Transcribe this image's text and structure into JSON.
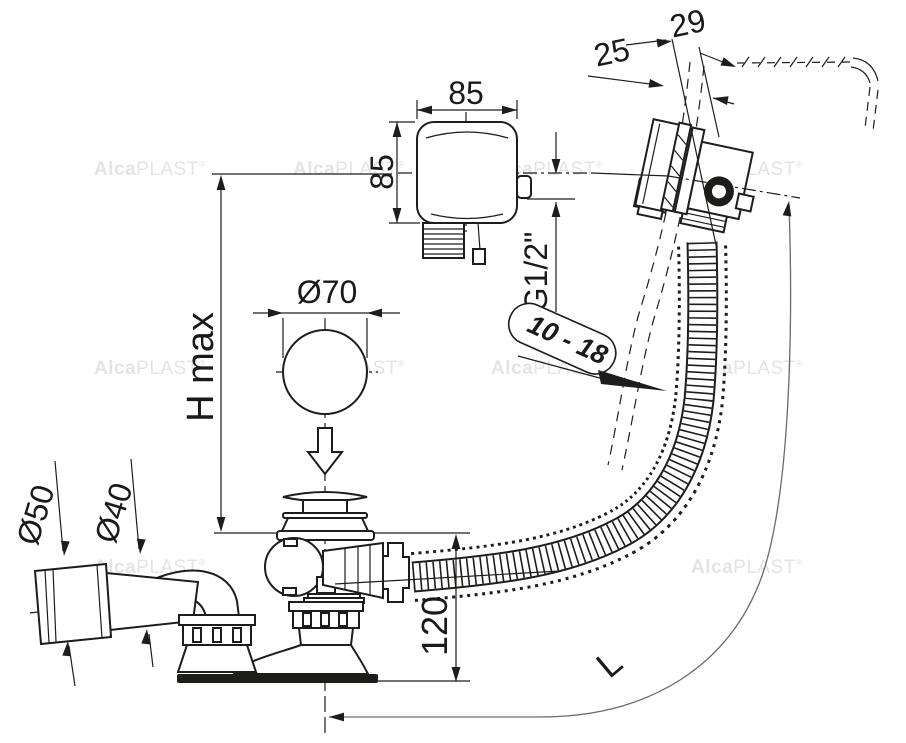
{
  "drawing": {
    "title": "bath waste and overflow set - dimensional drawing",
    "dims": {
      "knob_width": "85",
      "knob_height": "85",
      "rim_total": "29",
      "rim_inner": "25",
      "thread": "G1/2\"",
      "wall_range": "10 - 18",
      "plug_diameter": "Ø70",
      "height_max": "H max",
      "outlet_large": "Ø50",
      "outlet_small": "Ø40",
      "under_bath_depth": "120",
      "hose_length": "L"
    },
    "colors": {
      "line": "#1d1d1b",
      "label": "#1a1a1a",
      "watermark": "#e4e4e4",
      "background": "#ffffff"
    },
    "watermark": {
      "bold": "Alca",
      "light": "PLAST",
      "reg": "®",
      "positions": [
        [
          150,
          170
        ],
        [
          349,
          170
        ],
        [
          547,
          170
        ],
        [
          747,
          170
        ],
        [
          150,
          369
        ],
        [
          349,
          369
        ],
        [
          547,
          369
        ],
        [
          747,
          369
        ],
        [
          150,
          568
        ],
        [
          349,
          568
        ],
        [
          547,
          568
        ],
        [
          747,
          568
        ]
      ]
    }
  }
}
